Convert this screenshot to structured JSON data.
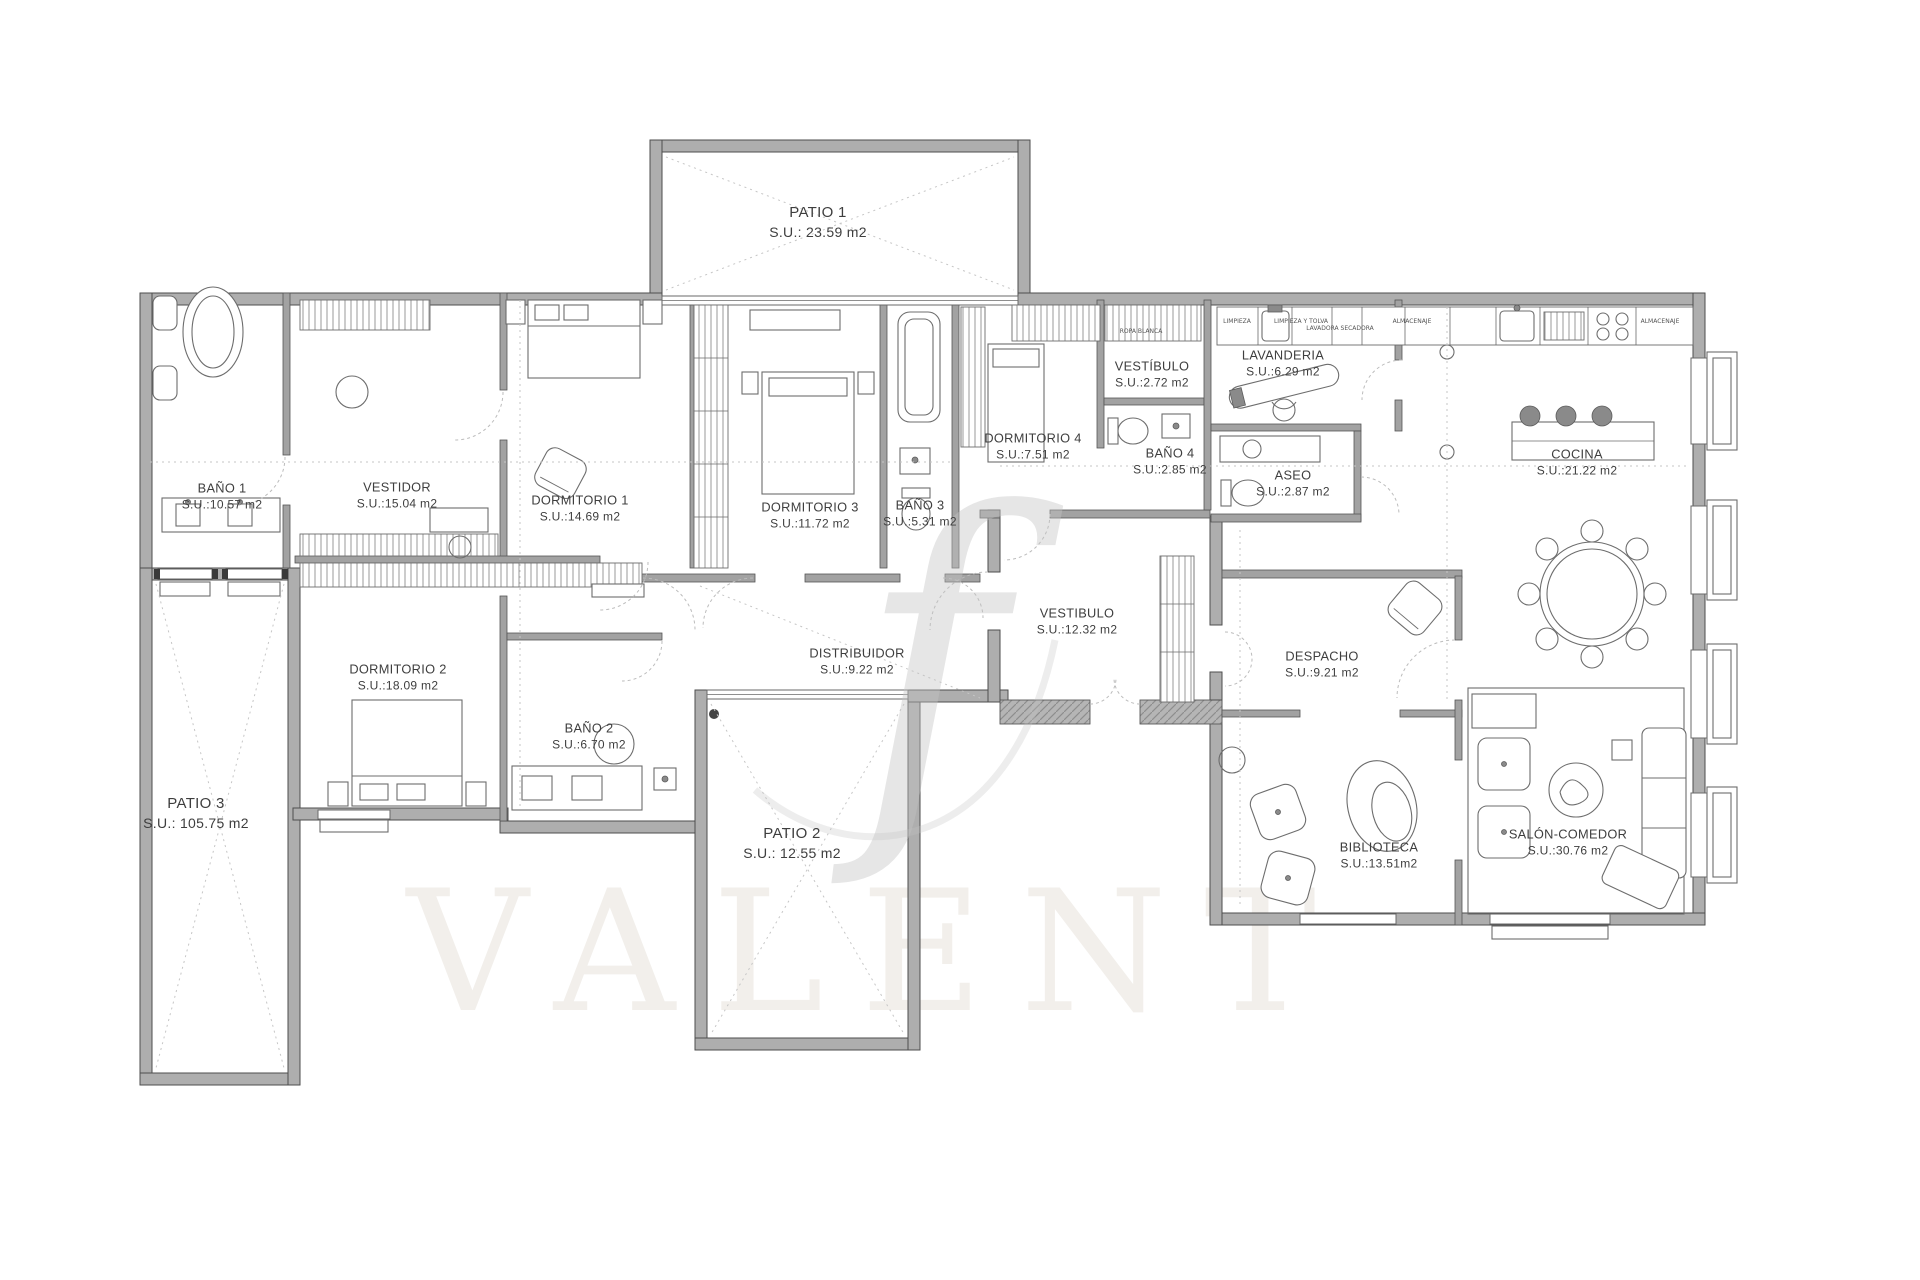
{
  "document": {
    "type": "apartment-floor-plan",
    "background": "#ffffff"
  },
  "colors": {
    "wall": "#aeaeae",
    "wall_edge": "#4e4e4e",
    "furniture_line": "#6d6d6d",
    "dotted_line": "#c6c6c6",
    "label_text": "#3e3e3e",
    "watermark": "#c4c4c4"
  },
  "rooms": [
    {
      "id": "patio-1",
      "name": "PATIO 1",
      "area": "S.U.: 23.59 m2",
      "x": 818,
      "y": 222
    },
    {
      "id": "bano-1",
      "name": "BAÑO 1",
      "area": "S.U.:10.57 m2",
      "x": 222,
      "y": 497
    },
    {
      "id": "vestidor",
      "name": "VESTIDOR",
      "area": "S.U.:15.04 m2",
      "x": 397,
      "y": 496
    },
    {
      "id": "dormitorio-1",
      "name": "DORMITORIO 1",
      "area": "S.U.:14.69 m2",
      "x": 580,
      "y": 509
    },
    {
      "id": "dormitorio-3",
      "name": "DORMITORIO 3",
      "area": "S.U.:11.72 m2",
      "x": 810,
      "y": 516
    },
    {
      "id": "bano-3",
      "name": "BAÑO 3",
      "area": "S.U.:5.31 m2",
      "x": 920,
      "y": 514
    },
    {
      "id": "dormitorio-4",
      "name": "DORMITORIO 4",
      "area": "S.U.:7.51 m2",
      "x": 1033,
      "y": 447
    },
    {
      "id": "vestibulo-dorm",
      "name": "VESTÍBULO",
      "area": "S.U.:2.72 m2",
      "x": 1152,
      "y": 375
    },
    {
      "id": "bano-4",
      "name": "BAÑO 4",
      "area": "S.U.:2.85 m2",
      "x": 1170,
      "y": 447
    },
    {
      "id": "lavanderia",
      "name": "LAVANDERIA",
      "area": "S.U.:6.29 m2",
      "x": 1283,
      "y": 364
    },
    {
      "id": "aseo",
      "name": "ASEO",
      "area": "S.U.:2.87 m2",
      "x": 1293,
      "y": 484
    },
    {
      "id": "cocina",
      "name": "COCINA",
      "area": "S.U.:21.22 m2",
      "x": 1577,
      "y": 463
    },
    {
      "id": "dormitorio-2",
      "name": "DORMITORIO 2",
      "area": "S.U.:18.09 m2",
      "x": 398,
      "y": 678
    },
    {
      "id": "bano-2",
      "name": "BAÑO 2",
      "area": "S.U.:6.70 m2",
      "x": 589,
      "y": 737
    },
    {
      "id": "patio-2",
      "name": "PATIO 2",
      "area": "S.U.: 12.55 m2",
      "x": 792,
      "y": 843
    },
    {
      "id": "patio-3",
      "name": "PATIO 3",
      "area": "S.U.: 105.75 m2",
      "x": 196,
      "y": 813
    },
    {
      "id": "vestibulo",
      "name": "VESTIBULO",
      "area": "S.U.:12.32 m2",
      "x": 1077,
      "y": 622
    },
    {
      "id": "distribuidor",
      "name": "DISTRIBUIDOR",
      "area": "S.U.:9.22 m2",
      "x": 857,
      "y": 662
    },
    {
      "id": "despacho",
      "name": "DESPACHO",
      "area": "S.U.:9.21 m2",
      "x": 1322,
      "y": 665
    },
    {
      "id": "biblioteca",
      "name": "BIBLIOTECA",
      "area": "S.U.:13.51m2",
      "x": 1379,
      "y": 856
    },
    {
      "id": "salon-comedor",
      "name": "SALÓN-COMEDOR",
      "area": "S.U.:30.76 m2",
      "x": 1568,
      "y": 843
    }
  ],
  "cabinets": [
    {
      "label": "LIMPIEZA",
      "x": 1237,
      "y": 323
    },
    {
      "label": "LIMPIEZA Y TOLVA",
      "x": 1301,
      "y": 323
    },
    {
      "label": "LAVADORA SECADORA",
      "x": 1340,
      "y": 323
    },
    {
      "label": "ALMACENAJE",
      "x": 1412,
      "y": 323
    },
    {
      "label": "ALMACENAJE",
      "x": 1660,
      "y": 323
    },
    {
      "label": "ROPA BLANCA",
      "x": 1141,
      "y": 333
    }
  ],
  "watermark": {
    "monogram": "f",
    "ghost_text": "VALENT"
  }
}
